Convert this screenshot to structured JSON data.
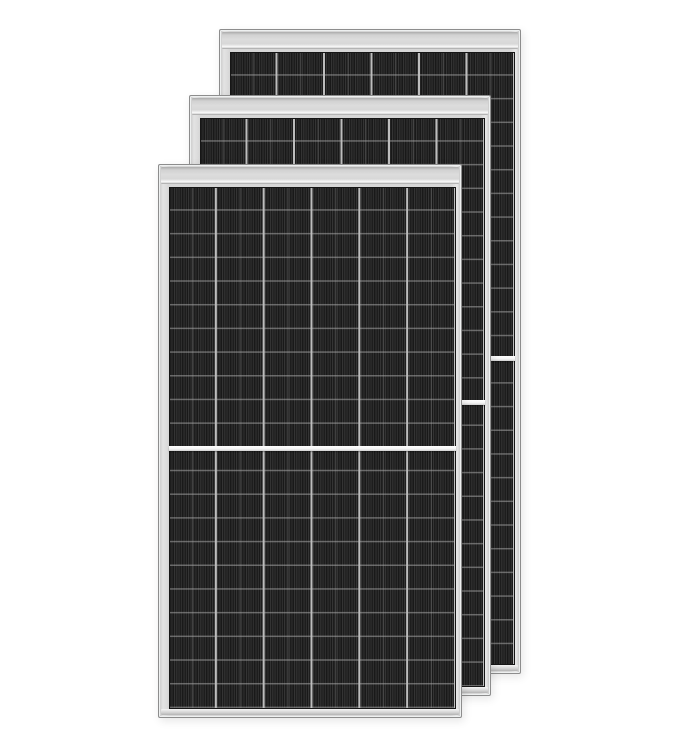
{
  "meta": {
    "description": "Product render: three identical all-black half-cut monocrystalline solar panel modules, stacked with a staggered offset on a plain white background. No text, labels or controls are visible.",
    "background_color": "#ffffff"
  },
  "panels": [
    {
      "id": "back",
      "label": "solar panel module (back)",
      "x": "219px",
      "y": "29px",
      "width": "302px",
      "height": "645px",
      "cell_columns": 6,
      "half_cut_divider": true
    },
    {
      "id": "middle",
      "label": "solar panel module (middle)",
      "x": "189px",
      "y": "95px",
      "width": "302px",
      "height": "601px",
      "cell_columns": 6,
      "half_cut_divider": true
    },
    {
      "id": "front",
      "label": "solar panel module (front)",
      "x": "158px",
      "y": "164px",
      "width": "304px",
      "height": "554px",
      "cell_columns": 6,
      "half_cut_divider": true
    }
  ],
  "grid": {
    "cell_columns": 6,
    "cell_row_height_px": 23.7,
    "cells_inset": {
      "top": 22,
      "left": 10,
      "right": 5,
      "bottom": 8
    }
  },
  "palette": {
    "frame": "#d6d6d6",
    "frame_edge": "#8d8d8d",
    "top_rail": "#dcdcdc",
    "cell_base": "#262626",
    "cell_stripe_dark": "#1d1d1d",
    "cell_stripe_light": "#343434",
    "column_gap": "#bdbdbd",
    "center_divider": "#f3f3f3"
  }
}
